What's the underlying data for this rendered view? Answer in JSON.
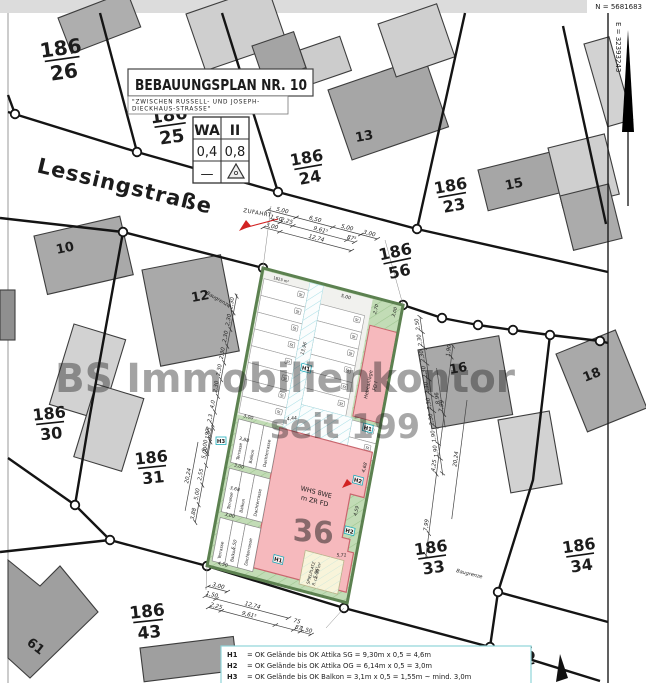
{
  "frame": {
    "north_coord": "N = 5681683",
    "east_coord": "E = 32393243"
  },
  "title_block": {
    "title": "BEBAUUNGSPLAN   NR. 10",
    "subtitle1": "\"ZWISCHEN RUSSELL- UND JOSEPH-",
    "subtitle2": "DIECKHAUS-STRASSE\""
  },
  "zoning_table": {
    "r1c1": "WA",
    "r1c2": "II",
    "r2c1": "0,4",
    "r2c2": "0,8",
    "r3c1": "—",
    "r3c2_icon": "roof-pitch-triangle"
  },
  "street": {
    "name": "Lessingstraße",
    "access": "ZUFAHRT"
  },
  "watermark": {
    "line1": "BS Immobilienkontor",
    "line2": "seit 199"
  },
  "parcels": [
    {
      "num": "186",
      "den": "26"
    },
    {
      "num": "186",
      "den": "25"
    },
    {
      "num": "186",
      "den": "24"
    },
    {
      "num": "186",
      "den": "23"
    },
    {
      "num": "186",
      "den": "56"
    },
    {
      "num": "186",
      "den": "30"
    },
    {
      "num": "186",
      "den": "31"
    },
    {
      "num": "186",
      "den": "33"
    },
    {
      "num": "186",
      "den": "34"
    },
    {
      "num": "186",
      "den": "43"
    },
    {
      "num": "186",
      "den": ""
    }
  ],
  "house_numbers": [
    "10",
    "12",
    "13",
    "15",
    "16",
    "18",
    "61"
  ],
  "plot": {
    "building_line1": "WHS 8WE",
    "building_line2": "m ZR FD",
    "heb1": "Hebeanlage",
    "heb2": "FD I",
    "spielplatz1": "SPIELPLATZ",
    "spielplatz2": "fl. ca. 30 m²",
    "terrasse": "Terrasse",
    "balkon": "Balkon",
    "dachterrasse": "Dachterrasse",
    "baugrenze": "Baugrenze",
    "area": "1823 m²",
    "stall": "St",
    "faint_parcel": "36"
  },
  "height_markers": [
    "H1",
    "H1",
    "H2",
    "H2",
    "H1",
    "H3"
  ],
  "legend": [
    {
      "key": "H1",
      "text": "= OK Gelände bis OK Attika SG = 9,30m x 0,5 = 4,6m"
    },
    {
      "key": "H2",
      "text": "= OK Gelände bis OK Attika OG = 6,14m x 0,5 = 3,0m"
    },
    {
      "key": "H3",
      "text": "= OK Gelände bis OK Balkon = 3,1m x 0,5 = 1,55m ~ mind. 3,0m"
    }
  ],
  "dims": {
    "top": [
      "5,00",
      "6,50",
      "5,00",
      "3,00",
      "1,50",
      "2,25",
      "9,61⁵",
      "87⁵",
      "3,00",
      "12,74"
    ],
    "bottom": [
      "3,00",
      "1,50",
      "12,74",
      "2,25",
      "9,61⁵",
      "75",
      "87",
      "1,50"
    ],
    "left_upper": [
      "2,30",
      "2,30",
      "2,30",
      "2,30",
      "2,30",
      "2,30",
      "4,0",
      "2,3",
      "97⁵",
      "5,00"
    ],
    "left_lower": [
      "1,95",
      "5,00",
      "2,55",
      "5,00",
      "3,88",
      "20,24"
    ],
    "right_inner": [
      "2,50",
      "2,30",
      "2,30",
      "2,30",
      "2,30",
      "2,30",
      "2,30",
      "8,96",
      "1,90",
      "1,90"
    ],
    "right_outer": [
      "1,90",
      "7,99",
      "4,25",
      "7,99",
      "20,24"
    ],
    "plot_purple": [
      "5,00",
      "2,70",
      "3,00",
      "13,96",
      "4,44",
      "3,00",
      "3,88",
      "3,00",
      "3,68",
      "3,00",
      "4,50",
      "4,68",
      "4,59",
      "5,71",
      "5,86⁵",
      "5,50"
    ]
  },
  "colors": {
    "plot_green": "#c2dcb6",
    "plot_border": "#5c8150",
    "building_pink": "#f6b9bd",
    "hatch_cyan": "#a9dfe6",
    "dim_purple": "#9b33cc",
    "marker_cyan": "#1fadbb",
    "arrow_red": "#d22222"
  }
}
